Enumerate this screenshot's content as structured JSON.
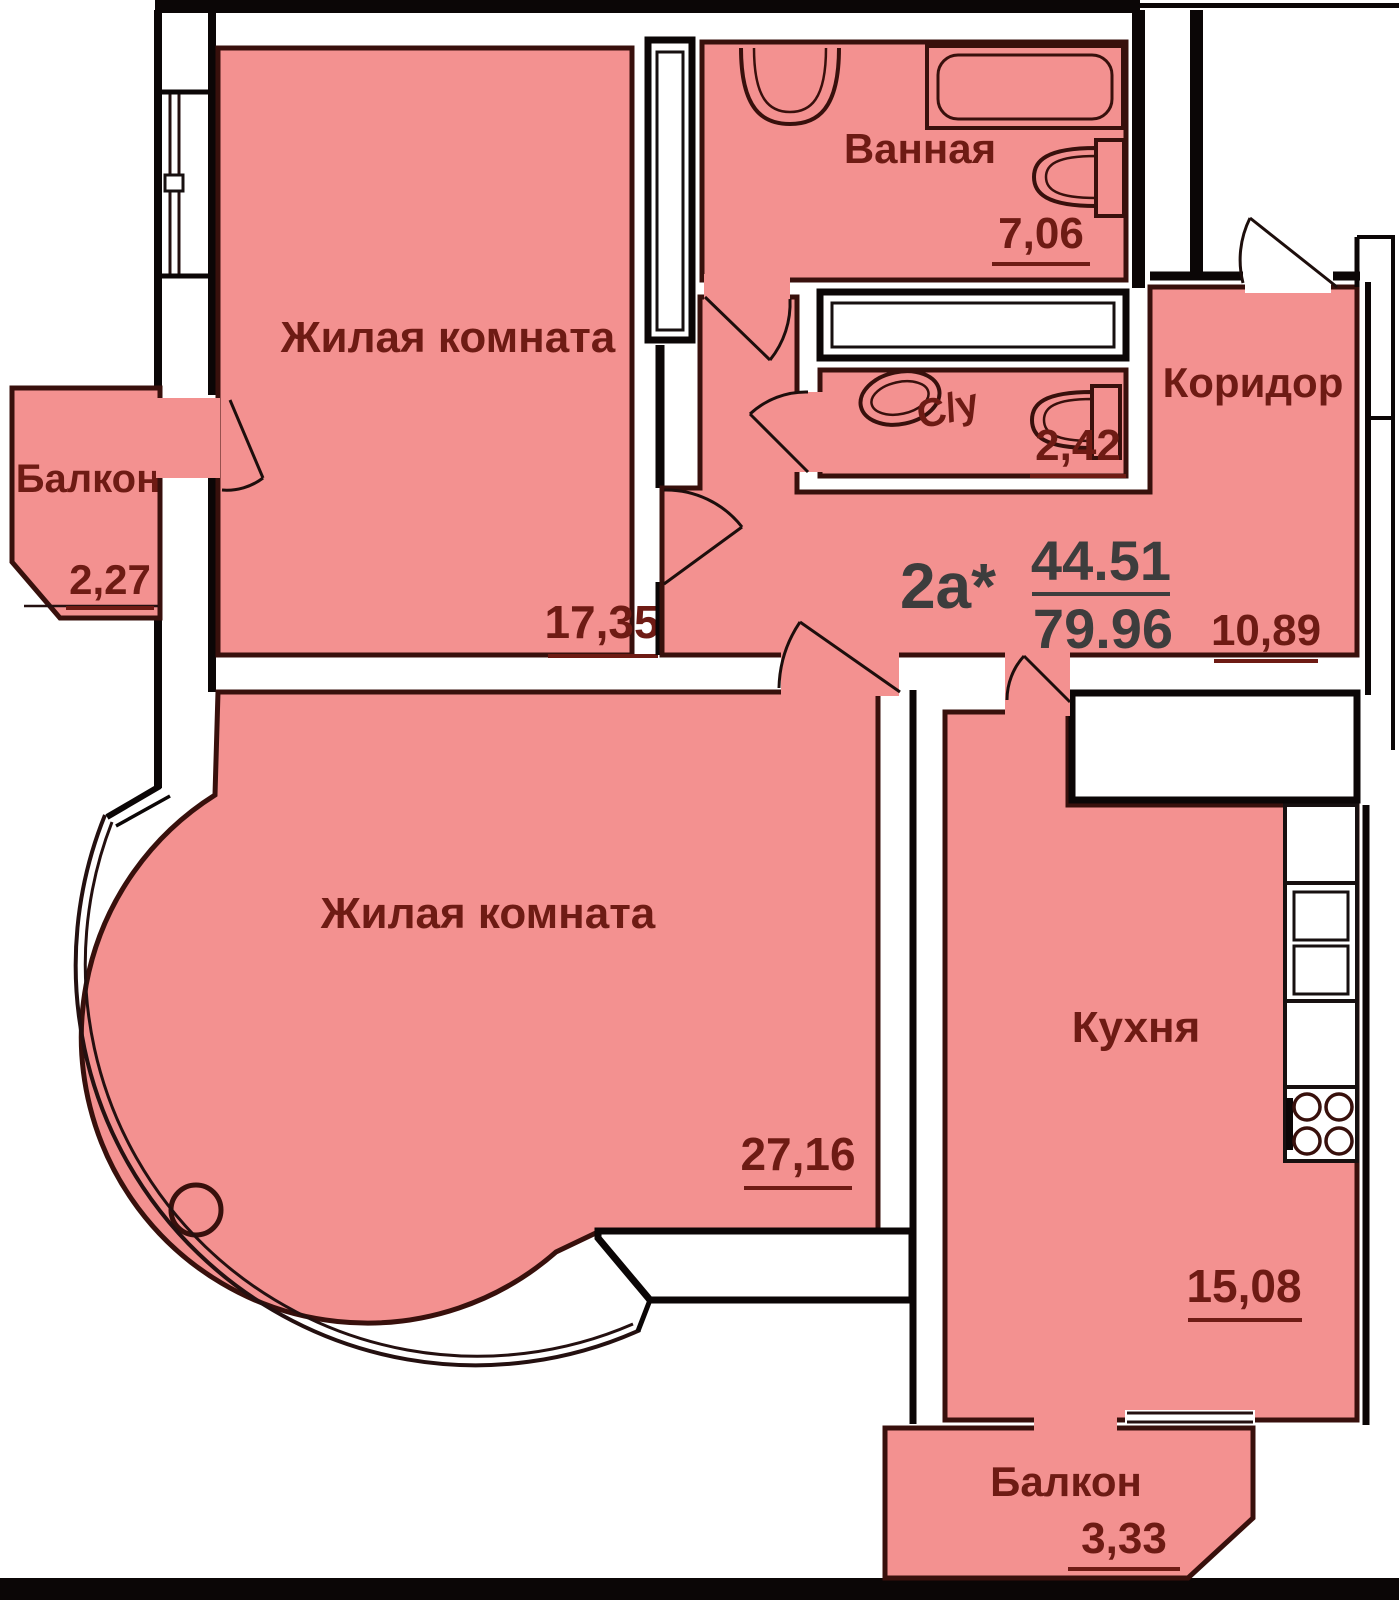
{
  "plan": {
    "unit_label": "2а*",
    "living_area": "44.51",
    "total_area": "79.96",
    "rooms": [
      {
        "id": "living-room-1",
        "name": "Жилая комната",
        "area": "17,35"
      },
      {
        "id": "bathroom",
        "name": "Ванная",
        "area": "7,06"
      },
      {
        "id": "wc",
        "name": "С/у",
        "area": "2,42"
      },
      {
        "id": "corridor",
        "name": "Коридор",
        "area": "10,89"
      },
      {
        "id": "living-room-2",
        "name": "Жилая комната",
        "area": "27,16"
      },
      {
        "id": "kitchen",
        "name": "Кухня",
        "area": "15,08"
      },
      {
        "id": "balcony-left",
        "name": "Балкон",
        "area": "2,27"
      },
      {
        "id": "balcony-bottom",
        "name": "Балкон",
        "area": "3,33"
      }
    ],
    "fixtures": [
      "bathtub",
      "bathroom-sink",
      "toilet",
      "wc-sink",
      "wc-toilet",
      "kitchen-counter",
      "kitchen-sink",
      "stove",
      "column"
    ],
    "colors": {
      "room_fill": "#f39190",
      "room_outline": "#38100c",
      "wall": "#0b0606",
      "label_text": "#6e1b14",
      "unit_text": "#3d3d3d",
      "background": "#ffffff"
    }
  }
}
